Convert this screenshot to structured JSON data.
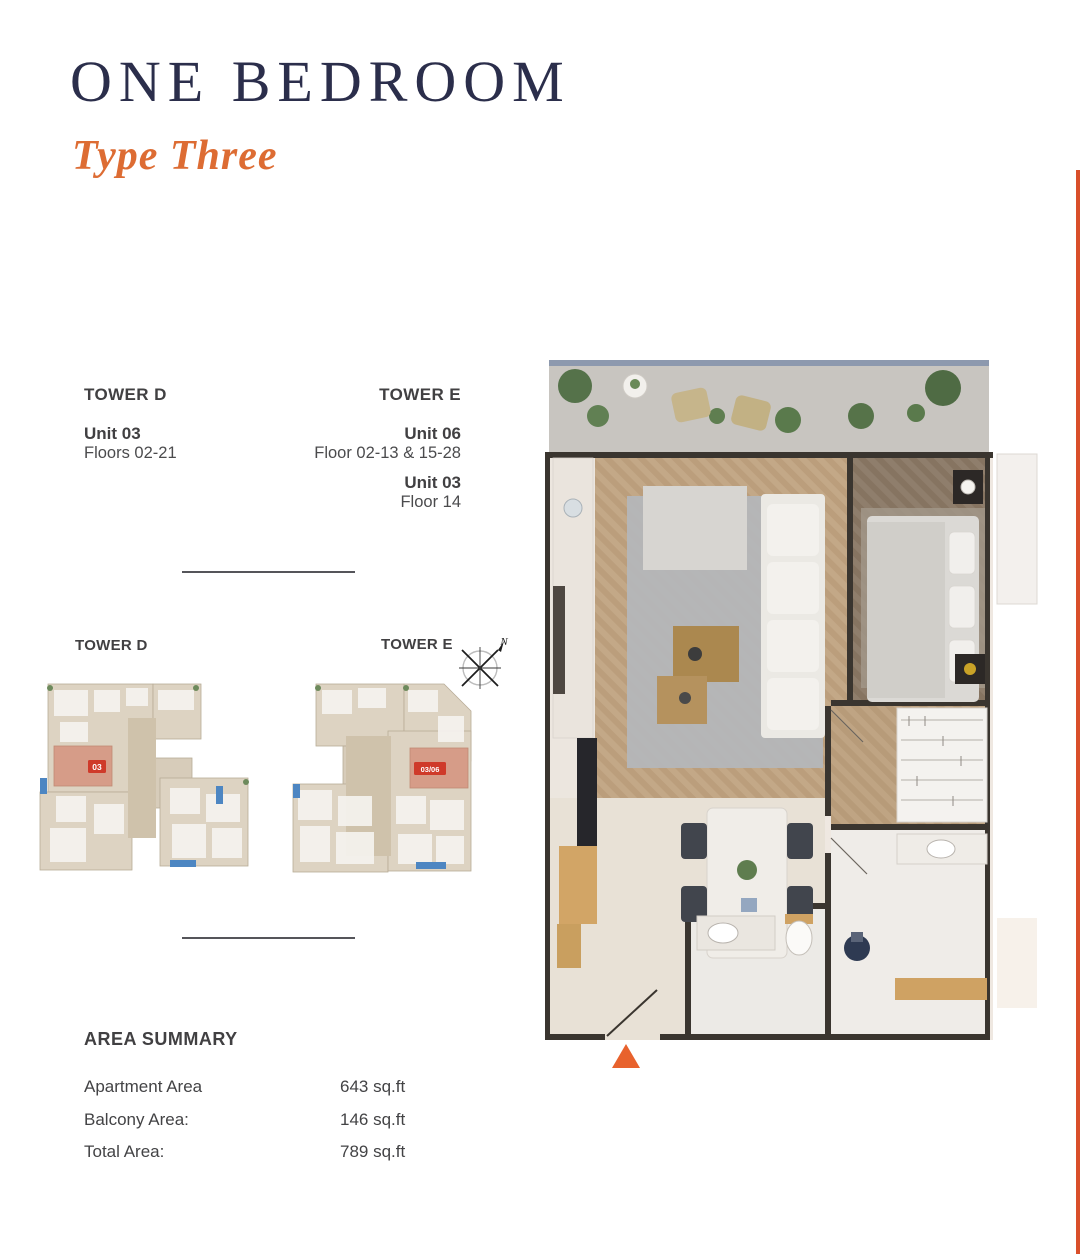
{
  "page": {
    "title": "ONE BEDROOM",
    "subtitle": "Type Three"
  },
  "towers_info": {
    "tower_d": {
      "name": "TOWER D",
      "units": [
        {
          "unit": "Unit 03",
          "floors": "Floors 02-21"
        }
      ]
    },
    "tower_e": {
      "name": "TOWER E",
      "units": [
        {
          "unit": "Unit 06",
          "floors": "Floor 02-13 & 15-28"
        },
        {
          "unit": "Unit 03",
          "floors": "Floor 14"
        }
      ]
    }
  },
  "key_plans": {
    "tower_d_label": "TOWER D",
    "tower_e_label": "TOWER E",
    "tower_d_unit_badge": "03",
    "tower_e_unit_badge": "03/06",
    "compass_label": "N"
  },
  "area_summary": {
    "heading": "AREA SUMMARY",
    "rows": [
      {
        "label": "Apartment Area",
        "value": "643 sq.ft"
      },
      {
        "label": "Balcony Area:",
        "value": "146 sq.ft"
      },
      {
        "label": "Total Area:",
        "value": "789 sq.ft"
      }
    ]
  },
  "colors": {
    "title_navy": "#2b2e4b",
    "accent_orange": "#dd6c33",
    "entry_arrow_orange": "#e8622d",
    "badge_red": "#cf3a2a",
    "highlight_unit_salmon": "#d69c88",
    "edge_strip": "#d94f2a",
    "text_dark": "#414042"
  }
}
